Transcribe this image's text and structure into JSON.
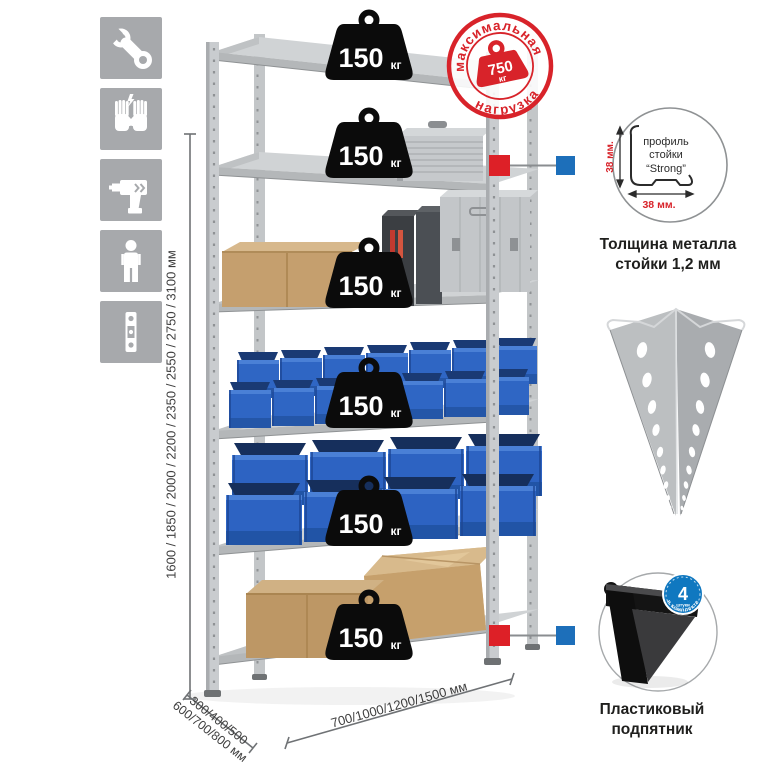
{
  "sidebar": {
    "icons": [
      {
        "name": "wrench-icon"
      },
      {
        "name": "gloves-icon"
      },
      {
        "name": "drill-icon"
      },
      {
        "name": "person-icon"
      },
      {
        "name": "level-icon"
      }
    ]
  },
  "dimensions": {
    "height": "1600 / 1850 / 2000 / 2200 / 2350 / 2550 / 2750 / 3100 мм",
    "depth_line1": "300/400/500",
    "depth_line2": "600/700/800 мм",
    "width": "700/1000/1200/1500 мм"
  },
  "stamp": {
    "arc_top": "максимальная",
    "arc_bottom": "нагрузка",
    "weight_value": "750",
    "weight_unit": "кг"
  },
  "rack": {
    "shelf_loads": [
      {
        "value": "150",
        "unit": "кг"
      },
      {
        "value": "150",
        "unit": "кг"
      },
      {
        "value": "150",
        "unit": "кг"
      },
      {
        "value": "150",
        "unit": "кг"
      },
      {
        "value": "150",
        "unit": "кг"
      },
      {
        "value": "150",
        "unit": "кг"
      }
    ]
  },
  "profile_detail": {
    "label_line1": "профиль",
    "label_line2": "стойки",
    "label_line3": "“Strong”",
    "dim_vertical": "38 мм.",
    "dim_horizontal": "38 мм.",
    "caption_line1": "Толщина металла",
    "caption_line2": "стойки 1,2 мм"
  },
  "foot_detail": {
    "badge_number": "4",
    "badge_small": "штуки",
    "badge_arc": "в комплекте",
    "caption_line1": "Пластиковый",
    "caption_line2": "подпятник"
  },
  "colors": {
    "red": "#d8232a",
    "blue": "#1d6fba",
    "icon_gray": "#a7a9ac",
    "bin_blue": "#2f66c4"
  }
}
